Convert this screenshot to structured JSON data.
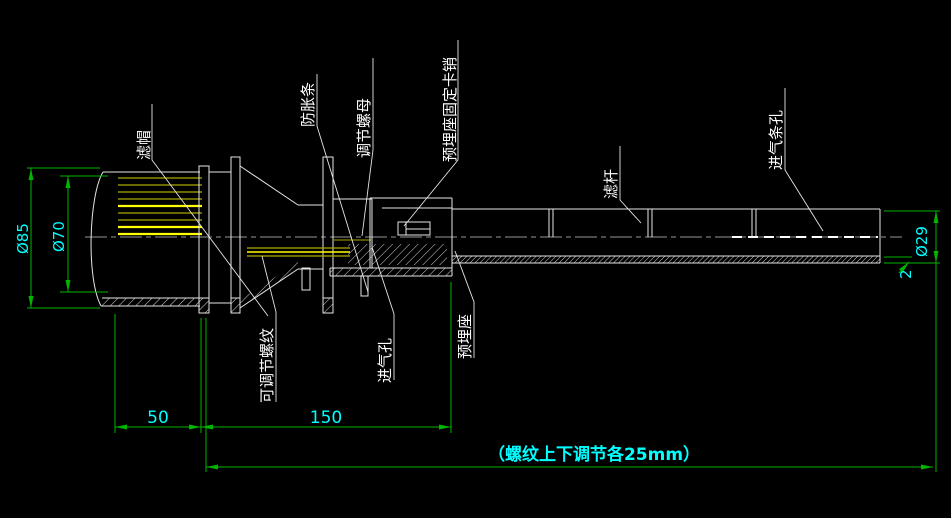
{
  "drawing": {
    "type": "cad-section-drawing",
    "background": "#000000",
    "colors": {
      "outline": "#e6e6e6",
      "centerline": "#c8c8c8",
      "slot_bright": "#ffff00",
      "slot_dim": "#a9a900",
      "dimension_line": "#00b400",
      "dimension_text": "#00ffff",
      "label_text": "#ffffff"
    },
    "labels": {
      "cap": "滤帽",
      "strip": "防胀条",
      "nut": "调节螺母",
      "pin": "预埋座固定卡销",
      "rod": "滤杆",
      "slots": "进气条孔",
      "thread": "可调节螺纹",
      "hole": "进气孔",
      "seat": "预埋座"
    },
    "dims": {
      "d85": "Ø85",
      "d70": "Ø70",
      "d29": "Ø29",
      "wall": "2",
      "l50": "50",
      "l150": "150",
      "note": "（螺纹上下调节各25mm）"
    }
  }
}
